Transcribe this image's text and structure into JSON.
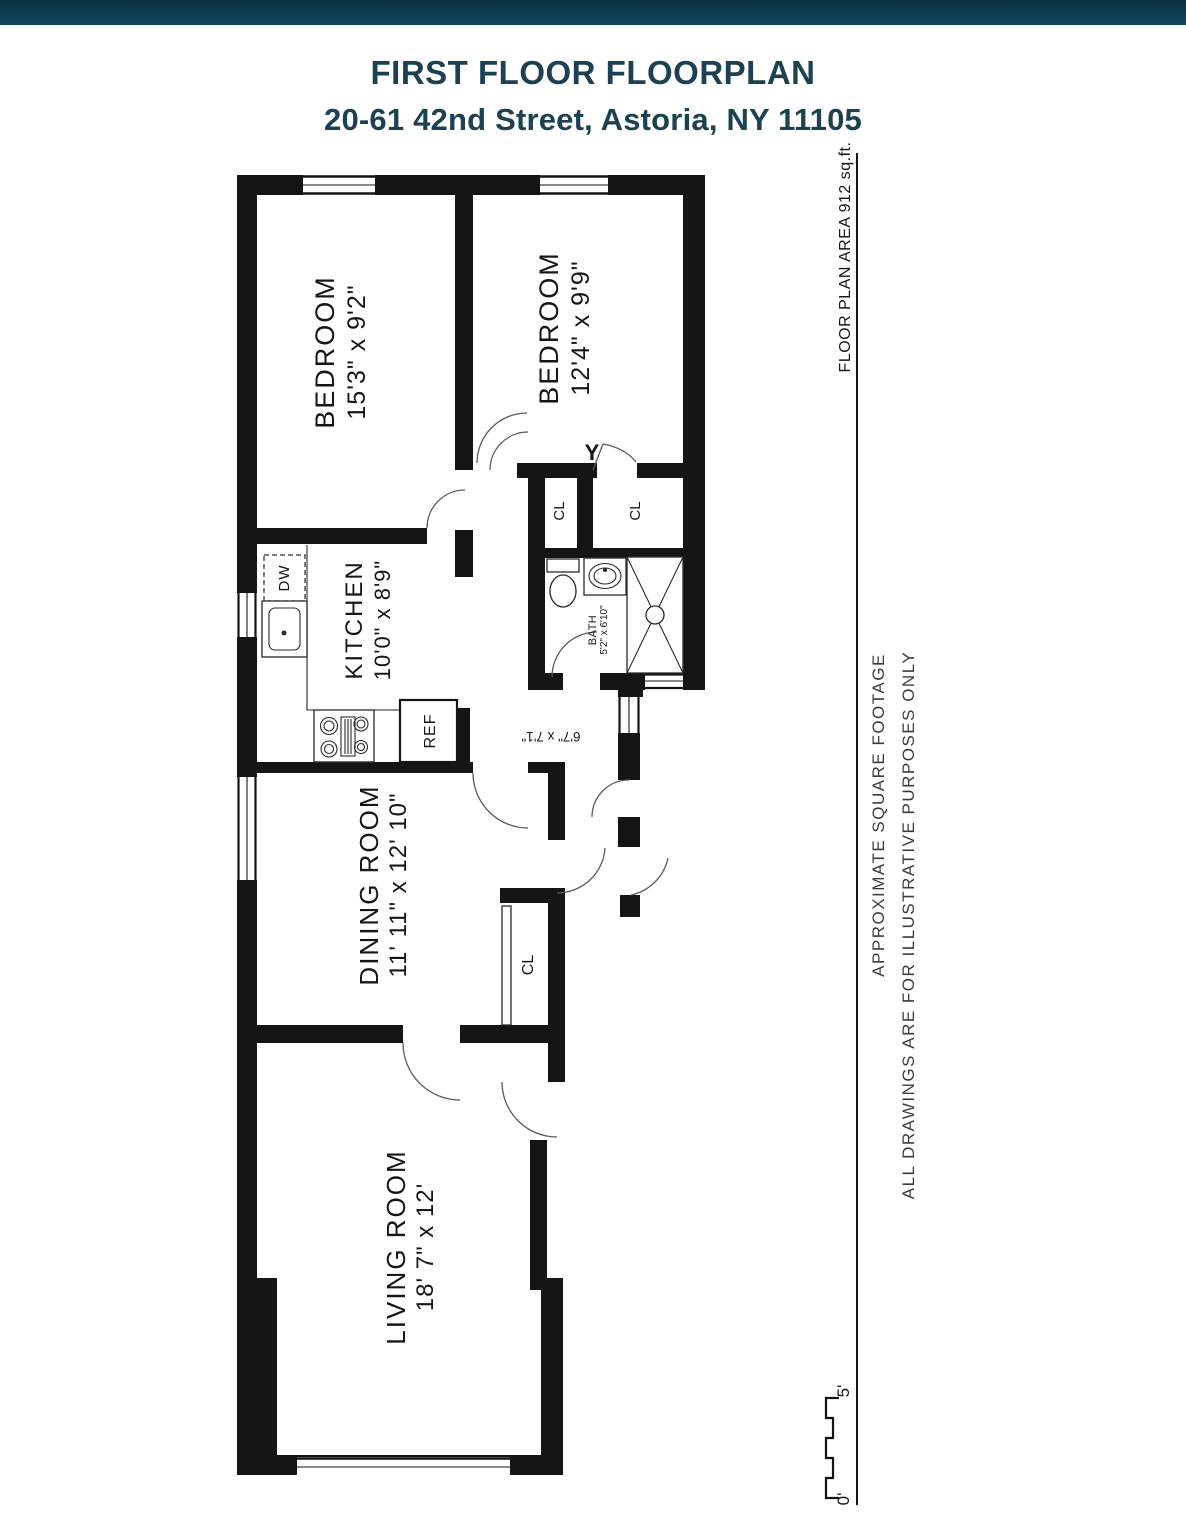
{
  "title": "FIRST FLOOR FLOORPLAN",
  "subtitle": "20-61 42nd Street, Astoria, NY 11105",
  "rooms": {
    "bedroom1": {
      "name": "BEDROOM",
      "dims": "15'3\" x 9'2\""
    },
    "bedroom2": {
      "name": "BEDROOM",
      "dims": "12'4\" x 9'9\""
    },
    "kitchen": {
      "name": "KITCHEN",
      "dims": "10'0\" x 8'9\""
    },
    "bath": {
      "name": "BATH",
      "dims": "5'2\" x 6'10\""
    },
    "dining": {
      "name": "DINING ROOM",
      "dims": "11' 11\" x 12' 10\""
    },
    "living": {
      "name": "LIVING ROOM",
      "dims": "18' 7\" x 12'"
    },
    "hall_dims": "6'7\" x 7'1\""
  },
  "labels": {
    "closet": "CL",
    "dishwasher": "DW",
    "refrigerator": "REF",
    "door_marker": "Y"
  },
  "annotations": {
    "floor_area": "FLOOR PLAN AREA 912 sq.ft.",
    "note_line1": "APPROXIMATE SQUARE FOOTAGE",
    "note_line2": "ALL DRAWINGS ARE FOR ILLUSTRATIVE PURPOSES ONLY"
  },
  "scale": {
    "top_label": "5'",
    "bottom_label": "0'"
  },
  "colors": {
    "accent": "#1b4152",
    "ink": "#141414",
    "header_bar_top": "#082f3e",
    "header_bar_bottom": "#11495c"
  }
}
